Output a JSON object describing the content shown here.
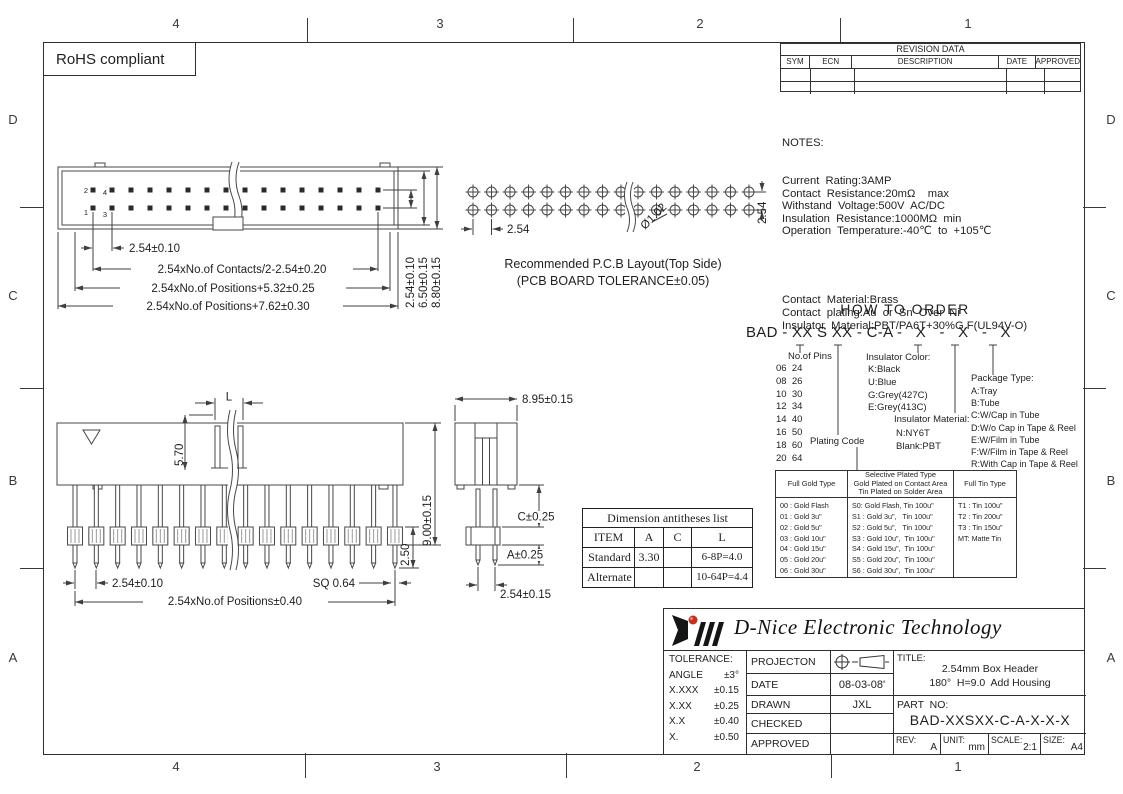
{
  "frame": {
    "rohs_label": "RoHS compliant",
    "zone_cols": [
      "4",
      "3",
      "2",
      "1"
    ],
    "zone_rows": [
      "D",
      "C",
      "B",
      "A"
    ]
  },
  "revision_table": {
    "title": "REVISION  DATA",
    "columns": [
      "SYM",
      "ECN",
      "DESCRIPTION",
      "DATE",
      "APPROVED"
    ]
  },
  "notes": {
    "heading": "NOTES:",
    "electrical": [
      "Current  Rating:3AMP",
      "Contact  Resistance:20mΩ    max",
      "Withstand  Voltage:500V  AC/DC",
      "Insulation  Resistance:1000MΩ  min",
      "Operation  Temperature:-40℃  to  +105℃"
    ],
    "material": [
      "Contact  Material:Brass",
      "Contact  plating:Au  or  Sn  Over  Ni",
      "Insulator  Material:PBT/PA6T+30%G.F(UL94V-O)"
    ]
  },
  "top_view": {
    "pin_labels": {
      "p2": "2",
      "p4": "4",
      "p1": "1",
      "p3": "3"
    },
    "dim_pitch": "2.54±0.10",
    "dim_contacts": "2.54xNo.of  Contacts/2-2.54±0.20",
    "dim_positions_a": "2.54xNo.of  Positions+5.32±0.25",
    "dim_positions_b": "2.54xNo.of  Positions+7.62±0.30",
    "vdim_a": "2.54±0.10",
    "vdim_b": "6.50±0.15",
    "vdim_c": "8.80±0.15"
  },
  "pcb_layout": {
    "dim_pitch": "2.54",
    "dim_hole": "Ø1.02",
    "dim_row": "2.54",
    "caption_line1": "Recommended  P.C.B  Layout(Top  Side)",
    "caption_line2": "(PCB  BOARD  TOLERANCE±0.05)"
  },
  "front_view": {
    "dim_l": "L",
    "dim_570": "5.70",
    "dim_height": "9.00±0.15",
    "dim_250": "2.50",
    "dim_pitch": "2.54±0.10",
    "dim_sq": "SQ  0.64",
    "dim_total": "2.54xNo.of  Positions±0.40"
  },
  "side_view": {
    "dim_width": "8.95±0.15",
    "dim_c": "C±0.25",
    "dim_a": "A±0.25",
    "dim_pitch": "2.54±0.15"
  },
  "dim_table": {
    "title": "Dimension antitheses list",
    "columns": [
      "ITEM",
      "A",
      "C",
      "L"
    ],
    "rows": [
      {
        "item": "Standard",
        "a": "3.30",
        "c": "",
        "l": "6-8P=4.0"
      },
      {
        "item": "Alternate",
        "a": "",
        "c": "",
        "l": "10-64P=4.4"
      }
    ]
  },
  "how_to_order": {
    "heading": "HOW TO ORDER",
    "code": "BAD - XX S XX - C-A -   X   -   X   -   X",
    "pins_label": "No.of Pins",
    "pins": [
      "06  24",
      "08  26",
      "10  30",
      "12  34",
      "14  40",
      "16  50",
      "18  60",
      "20  64"
    ],
    "color_label": "Insulator Color:",
    "colors": [
      "K:Black",
      "U:Blue",
      "G:Grey(427C)",
      "E:Grey(413C)"
    ],
    "material_label": "Insulator Material:",
    "materials": [
      "N:NY6T",
      "Blank:PBT"
    ],
    "package_label": "Package Type:",
    "packages": [
      "A:Tray",
      "B:Tube",
      "C:W/Cap in Tube",
      "D:W/o Cap in Tape & Reel",
      "E:W/Film in Tube",
      "F:W/Film in Tape & Reel",
      "R:With Cap in Tape & Reel"
    ],
    "plating_label": "Plating Code"
  },
  "plating_table": {
    "gold_header": "Full Gold Type",
    "selective_header": [
      "Selective Plated Type",
      "Gold Plated on Contact Area",
      "Tin Plated on Solder Area"
    ],
    "tin_header": "Full Tin Type",
    "gold": [
      "00 : Gold Flash",
      "01 : Gold 3u\"",
      "02 : Gold 5u\"",
      "03 : Gold 10u\"",
      "04 : Gold 15u\"",
      "05 : Gold 20u\"",
      "06 : Gold 30u\""
    ],
    "selective": [
      "S0: Gold Flash, Tin 100u\"",
      "S1 : Gold 3u\",   Tin 100u\"",
      "S2 : Gold 5u\",   Tin 100u\"",
      "S3 : Gold 10u\",  Tin 100u\"",
      "S4 : Gold 15u\",  Tin 100u\"",
      "S5 : Gold 20u\",  Tin 100u\"",
      "S6 : Gold 30u\",  Tin 100u\""
    ],
    "tin": [
      "T1 : Tin 100u\"",
      "T2 : Tin 200u\"",
      "T3 : Tin 150u\"",
      "MT: Matte Tin"
    ]
  },
  "title_block": {
    "company": "D-Nice Electronic Technology",
    "tolerance_label": "TOLERANCE:",
    "tolerances": [
      {
        "l": "ANGLE",
        "r": "±3°"
      },
      {
        "l": "X.XXX",
        "r": "±0.15"
      },
      {
        "l": "X.XX",
        "r": "±0.25"
      },
      {
        "l": "X.X",
        "r": "±0.40"
      },
      {
        "l": "X.",
        "r": "±0.50"
      }
    ],
    "rows": [
      {
        "label": "PROJECTON",
        "value": ""
      },
      {
        "label": "DATE",
        "value": "08-03-08'"
      },
      {
        "label": "DRAWN",
        "value": "JXL"
      },
      {
        "label": "CHECKED",
        "value": ""
      },
      {
        "label": "APPROVED",
        "value": ""
      }
    ],
    "title_label": "TITLE:",
    "title_line1": "2.54mm Box Header",
    "title_line2": "180°  H=9.0  Add Housing",
    "part_label": "PART  NO:",
    "part_no": "BAD-XXSXX-C-A-X-X-X",
    "rev_label": "REV:",
    "rev": "A",
    "unit_label": "UNIT:",
    "unit": "mm",
    "scale_label": "SCALE:",
    "scale": "2:1",
    "size_label": "SIZE:",
    "size": "A4"
  }
}
